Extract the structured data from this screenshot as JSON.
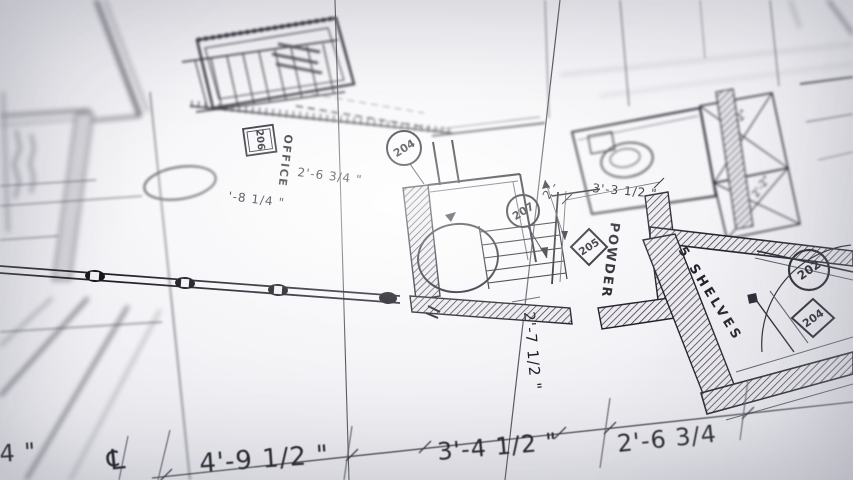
{
  "photo": {
    "description": "Architectural blueprint floor plan photographed at an angle with shallow depth of field",
    "paper_color": "#f5f4f7",
    "ink_color": "#20202a"
  },
  "labels": {
    "office": "OFFICE",
    "powder": "POWDER",
    "shelves": "5 SHELVES"
  },
  "tags": {
    "office_box": "206",
    "door_circle_a": "204",
    "door_circle_b": "207",
    "powder_diamond": "205",
    "shelves_circle": "202",
    "shelves_diamond": "204"
  },
  "dims": {
    "top_left_partial": "'-8 1/4 \"",
    "office_width": "2'-6 3/4 \"",
    "hall_width": "3'-3 1/2 \"",
    "near_207": "2'-",
    "powder_depth": "2'-7 1/2 \"",
    "closet_a": "2'-2\"",
    "closet_b": "2'-2\"",
    "bottom_left_partial": "4 \"",
    "centerline_symbol": "℄",
    "bottom_a": "4'-9 1/2 \"",
    "bottom_b": "3'-4 1/2 \"",
    "bottom_c": "2'-6 3/4"
  }
}
